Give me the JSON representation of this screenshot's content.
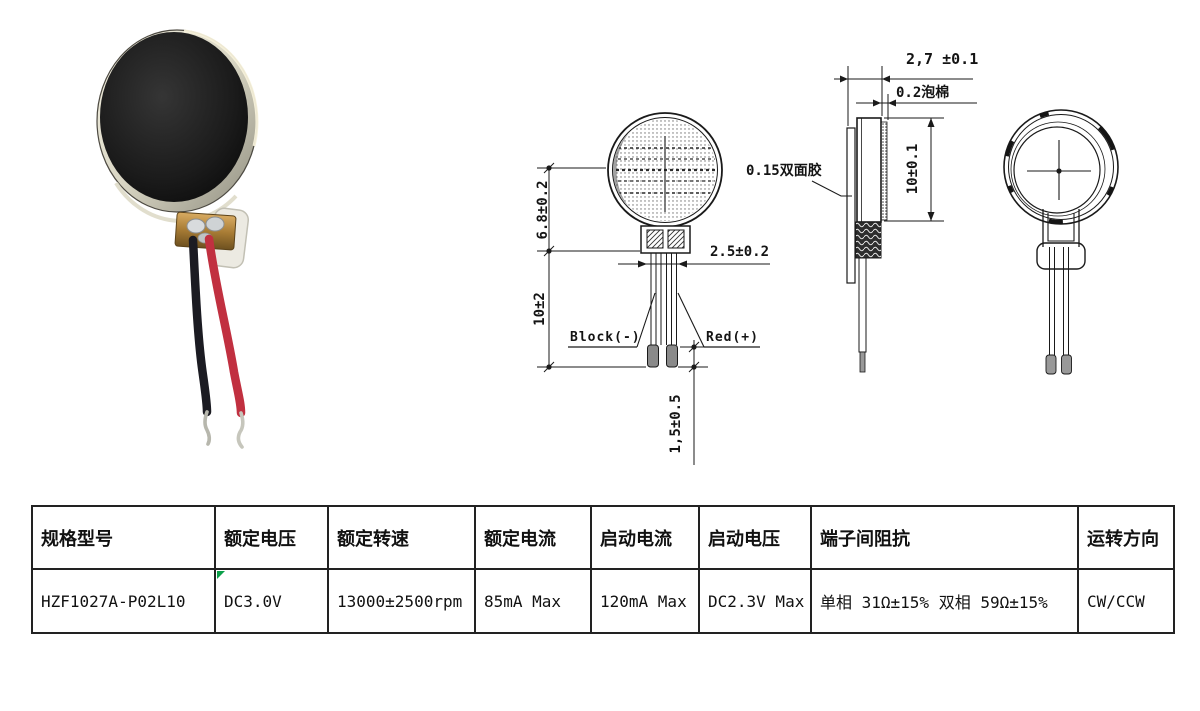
{
  "product_photo": {
    "name": "coin-vibration-motor-photo",
    "wire_black_color": "#1b1b22",
    "wire_red_color": "#c13040",
    "body_color": "#151515",
    "rim_color": "#e8e4d2",
    "tab_color": "#b8893f"
  },
  "drawings": {
    "line_color": "#1a1a1a",
    "front_view": {
      "dim_body_height": "6.8±0.2",
      "dim_lead_length": "10±2",
      "dim_terminal_width": "2.5±0.2",
      "dim_tip_length": "1,5±0.5",
      "black_lead_label": "Block(-)",
      "red_lead_label": "Red(+)"
    },
    "side_view": {
      "dim_thickness": "2,7 ±0.1",
      "foam_label": "0.2泡棉",
      "dim_diameter": "10±0.1",
      "adhesive_label": "0.15双面胶"
    }
  },
  "spec_table": {
    "marker_color": "#0ca04a",
    "headers": [
      "规格型号",
      "额定电压",
      "额定转速",
      "额定电流",
      "启动电流",
      "启动电压",
      "端子间阻抗",
      "运转方向"
    ],
    "row": [
      "HZF1027A-P02L10",
      "DC3.0V",
      "13000±2500rpm",
      "85mA Max",
      "120mA Max",
      "DC2.3V Max",
      "单相 31Ω±15% 双相 59Ω±15%",
      "CW/CCW"
    ]
  }
}
